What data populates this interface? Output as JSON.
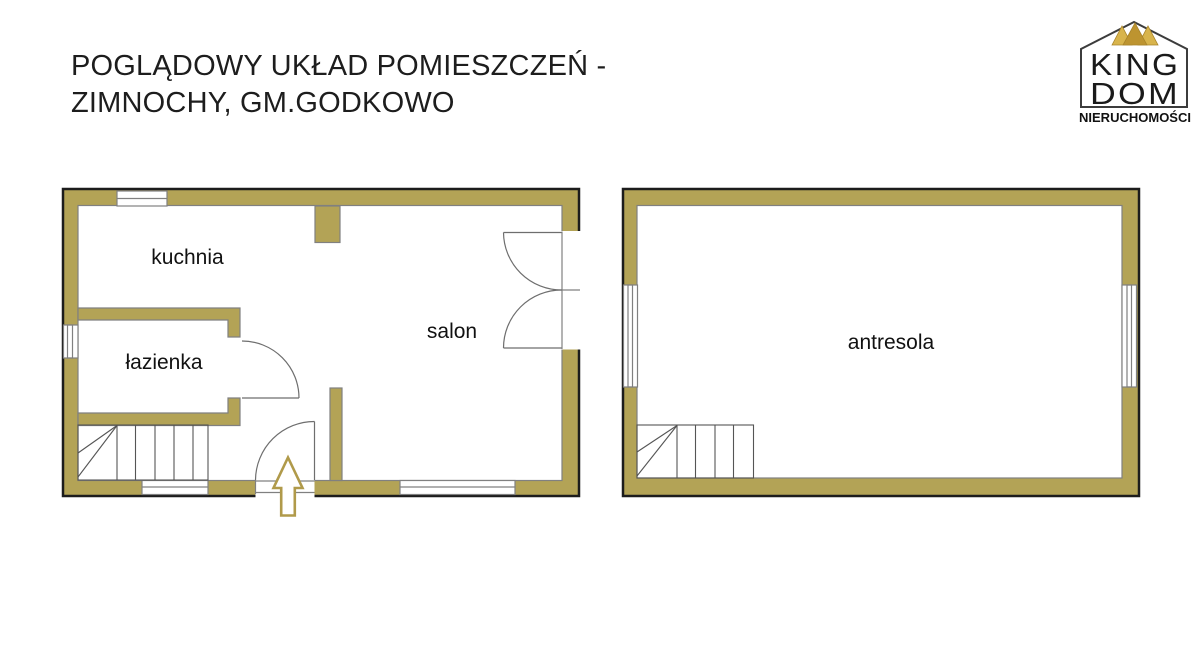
{
  "title": {
    "line1": "POGLĄDOWY UKŁAD POMIESZCZEŃ -",
    "line2": "ZIMNOCHY, GM.GODKOWO"
  },
  "logo": {
    "king": "KING",
    "dom": "DOM",
    "subtitle": "NIERUCHOMOŚCI"
  },
  "floor_plans": {
    "ground_floor": {
      "rooms": [
        {
          "name": "kuchnia"
        },
        {
          "name": "łazienka"
        },
        {
          "name": "salon"
        }
      ],
      "entrance_marker": "arrow-up"
    },
    "mezzanine": {
      "rooms": [
        {
          "name": "antresola"
        }
      ]
    }
  },
  "colors": {
    "wall": "#b3a356",
    "outline": "#1c1c1c",
    "thin_line": "#808080",
    "arrow_gold": "#b09a4a",
    "crown_light": "#d8b44c",
    "crown_dark": "#bd9430"
  }
}
